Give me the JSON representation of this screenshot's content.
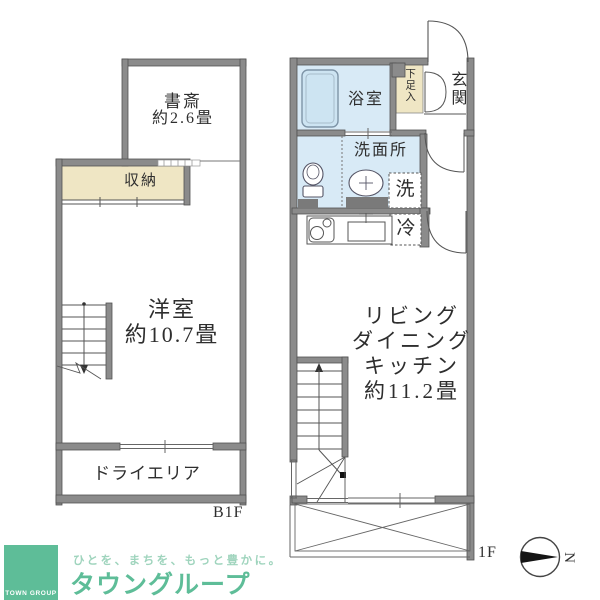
{
  "colors": {
    "wall_gray": "#8b8b8b",
    "line_dark": "#555555",
    "water_blue": "#d8eaf6",
    "bathtub_blue": "#cde4f2",
    "tatami_beige": "#efe6c4",
    "counter_gray": "#7a7a7a",
    "brand_green": "#5ebd98",
    "tagline_green": "#9fd4bd"
  },
  "b1f": {
    "floor_label": "B1F",
    "study_name": "書斎",
    "study_size": "約2.6畳",
    "storage_label": "収納",
    "room_name": "洋室",
    "room_size": "約10.7畳",
    "dry_area_label": "ドライエリア"
  },
  "f1": {
    "floor_label": "1F",
    "bathroom_label": "浴室",
    "shoe_cabinet_label": "下足入",
    "entrance_label": "玄関",
    "washroom_label": "洗面所",
    "washer_label": "洗",
    "fridge_label": "冷",
    "ldk_lines": [
      "リビング",
      "ダイニング",
      "キッチン",
      "約11.2畳"
    ]
  },
  "compass": {
    "north_label": "N"
  },
  "branding": {
    "logo_square_text": "TOWN GROUP",
    "tagline": "ひとを、まちを、もっと豊かに。",
    "company_name": "タウングループ"
  }
}
